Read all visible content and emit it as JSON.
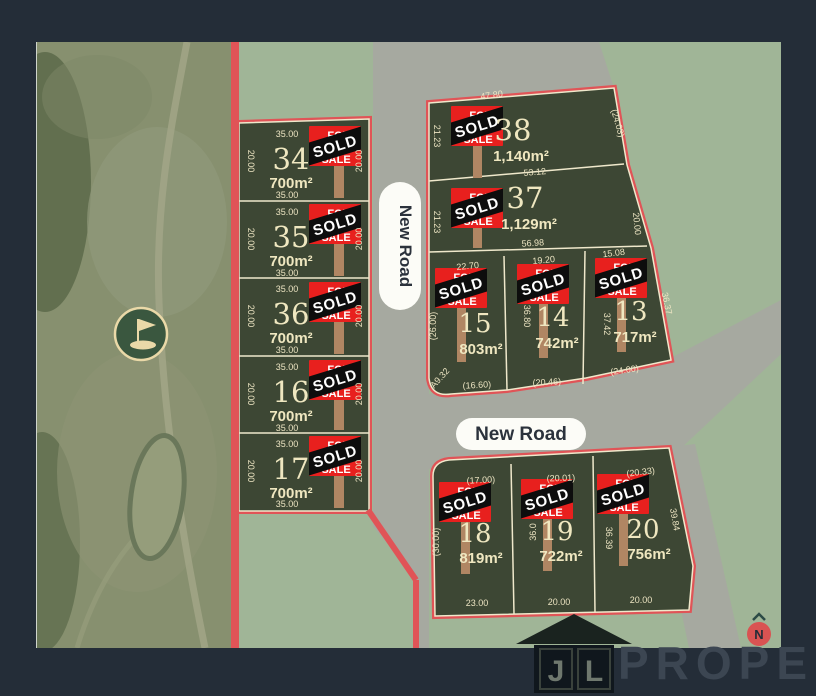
{
  "roads": {
    "vertical_label": "New Road",
    "horizontal_label": "New Road"
  },
  "sign": {
    "line1": "FOR",
    "line2": "SALE",
    "banner": "SOLD"
  },
  "compass": {
    "label": "N"
  },
  "watermark": {
    "j": "J",
    "l": "L",
    "property": "PROPERTY"
  },
  "colors": {
    "background": "#242d38",
    "sage": "#a0b597",
    "road_gray": "#a6a9a0",
    "lot_fill": "#3d4734",
    "lot_border": "#efe8cb",
    "boundary_red": "#e05457",
    "sign_red": "#e8201e",
    "sold_black": "#0d0d0d",
    "post_brown": "#b08663"
  },
  "lots": [
    {
      "number": "34",
      "area": "700m²",
      "dims": {
        "top": "35.00",
        "bottom": "35.00",
        "left": "20.00",
        "right": "20.00"
      }
    },
    {
      "number": "35",
      "area": "700m²",
      "dims": {
        "top": "35.00",
        "bottom": "35.00",
        "left": "20.00",
        "right": "20.00"
      }
    },
    {
      "number": "36",
      "area": "700m²",
      "dims": {
        "top": "35.00",
        "bottom": "35.00",
        "left": "20.00",
        "right": "20.00"
      }
    },
    {
      "number": "16",
      "area": "700m²",
      "dims": {
        "top": "35.00",
        "bottom": "35.00",
        "left": "20.00",
        "right": "20.00"
      }
    },
    {
      "number": "17",
      "area": "700m²",
      "dims": {
        "top": "35.00",
        "bottom": "35.00",
        "left": "20.00",
        "right": "20.00"
      }
    },
    {
      "number": "38",
      "area": "1,140m²",
      "dims": {
        "top": "47.80",
        "left": "21.23",
        "right": "(24.03)",
        "bottom": "53.12"
      }
    },
    {
      "number": "37",
      "area": "1,129m²",
      "dims": {
        "left": "21.23",
        "right": "20.00",
        "bottom": "56.98"
      }
    },
    {
      "number": "15",
      "area": "803m²",
      "dims": {
        "top": "22.70",
        "left": "(26.00)",
        "bottom": "(16.60)",
        "arc": "A9.32"
      }
    },
    {
      "number": "14",
      "area": "742m²",
      "dims": {
        "top": "19.20",
        "left": "36.80",
        "bottom": "(20.46)"
      }
    },
    {
      "number": "13",
      "area": "717m²",
      "dims": {
        "top": "15.08",
        "left": "37.42",
        "right": "36.37",
        "bottom": "(24.00)"
      }
    },
    {
      "number": "18",
      "area": "819m²",
      "dims": {
        "top": "(17.00)",
        "left": "(30.00)",
        "bottom": "23.00"
      }
    },
    {
      "number": "19",
      "area": "722m²",
      "dims": {
        "top": "(20.01)",
        "left": "36.0",
        "bottom": "20.00"
      }
    },
    {
      "number": "20",
      "area": "756m²",
      "dims": {
        "top": "(20.33)",
        "left": "36.39",
        "right": "39.84",
        "bottom": "20.00"
      }
    }
  ]
}
